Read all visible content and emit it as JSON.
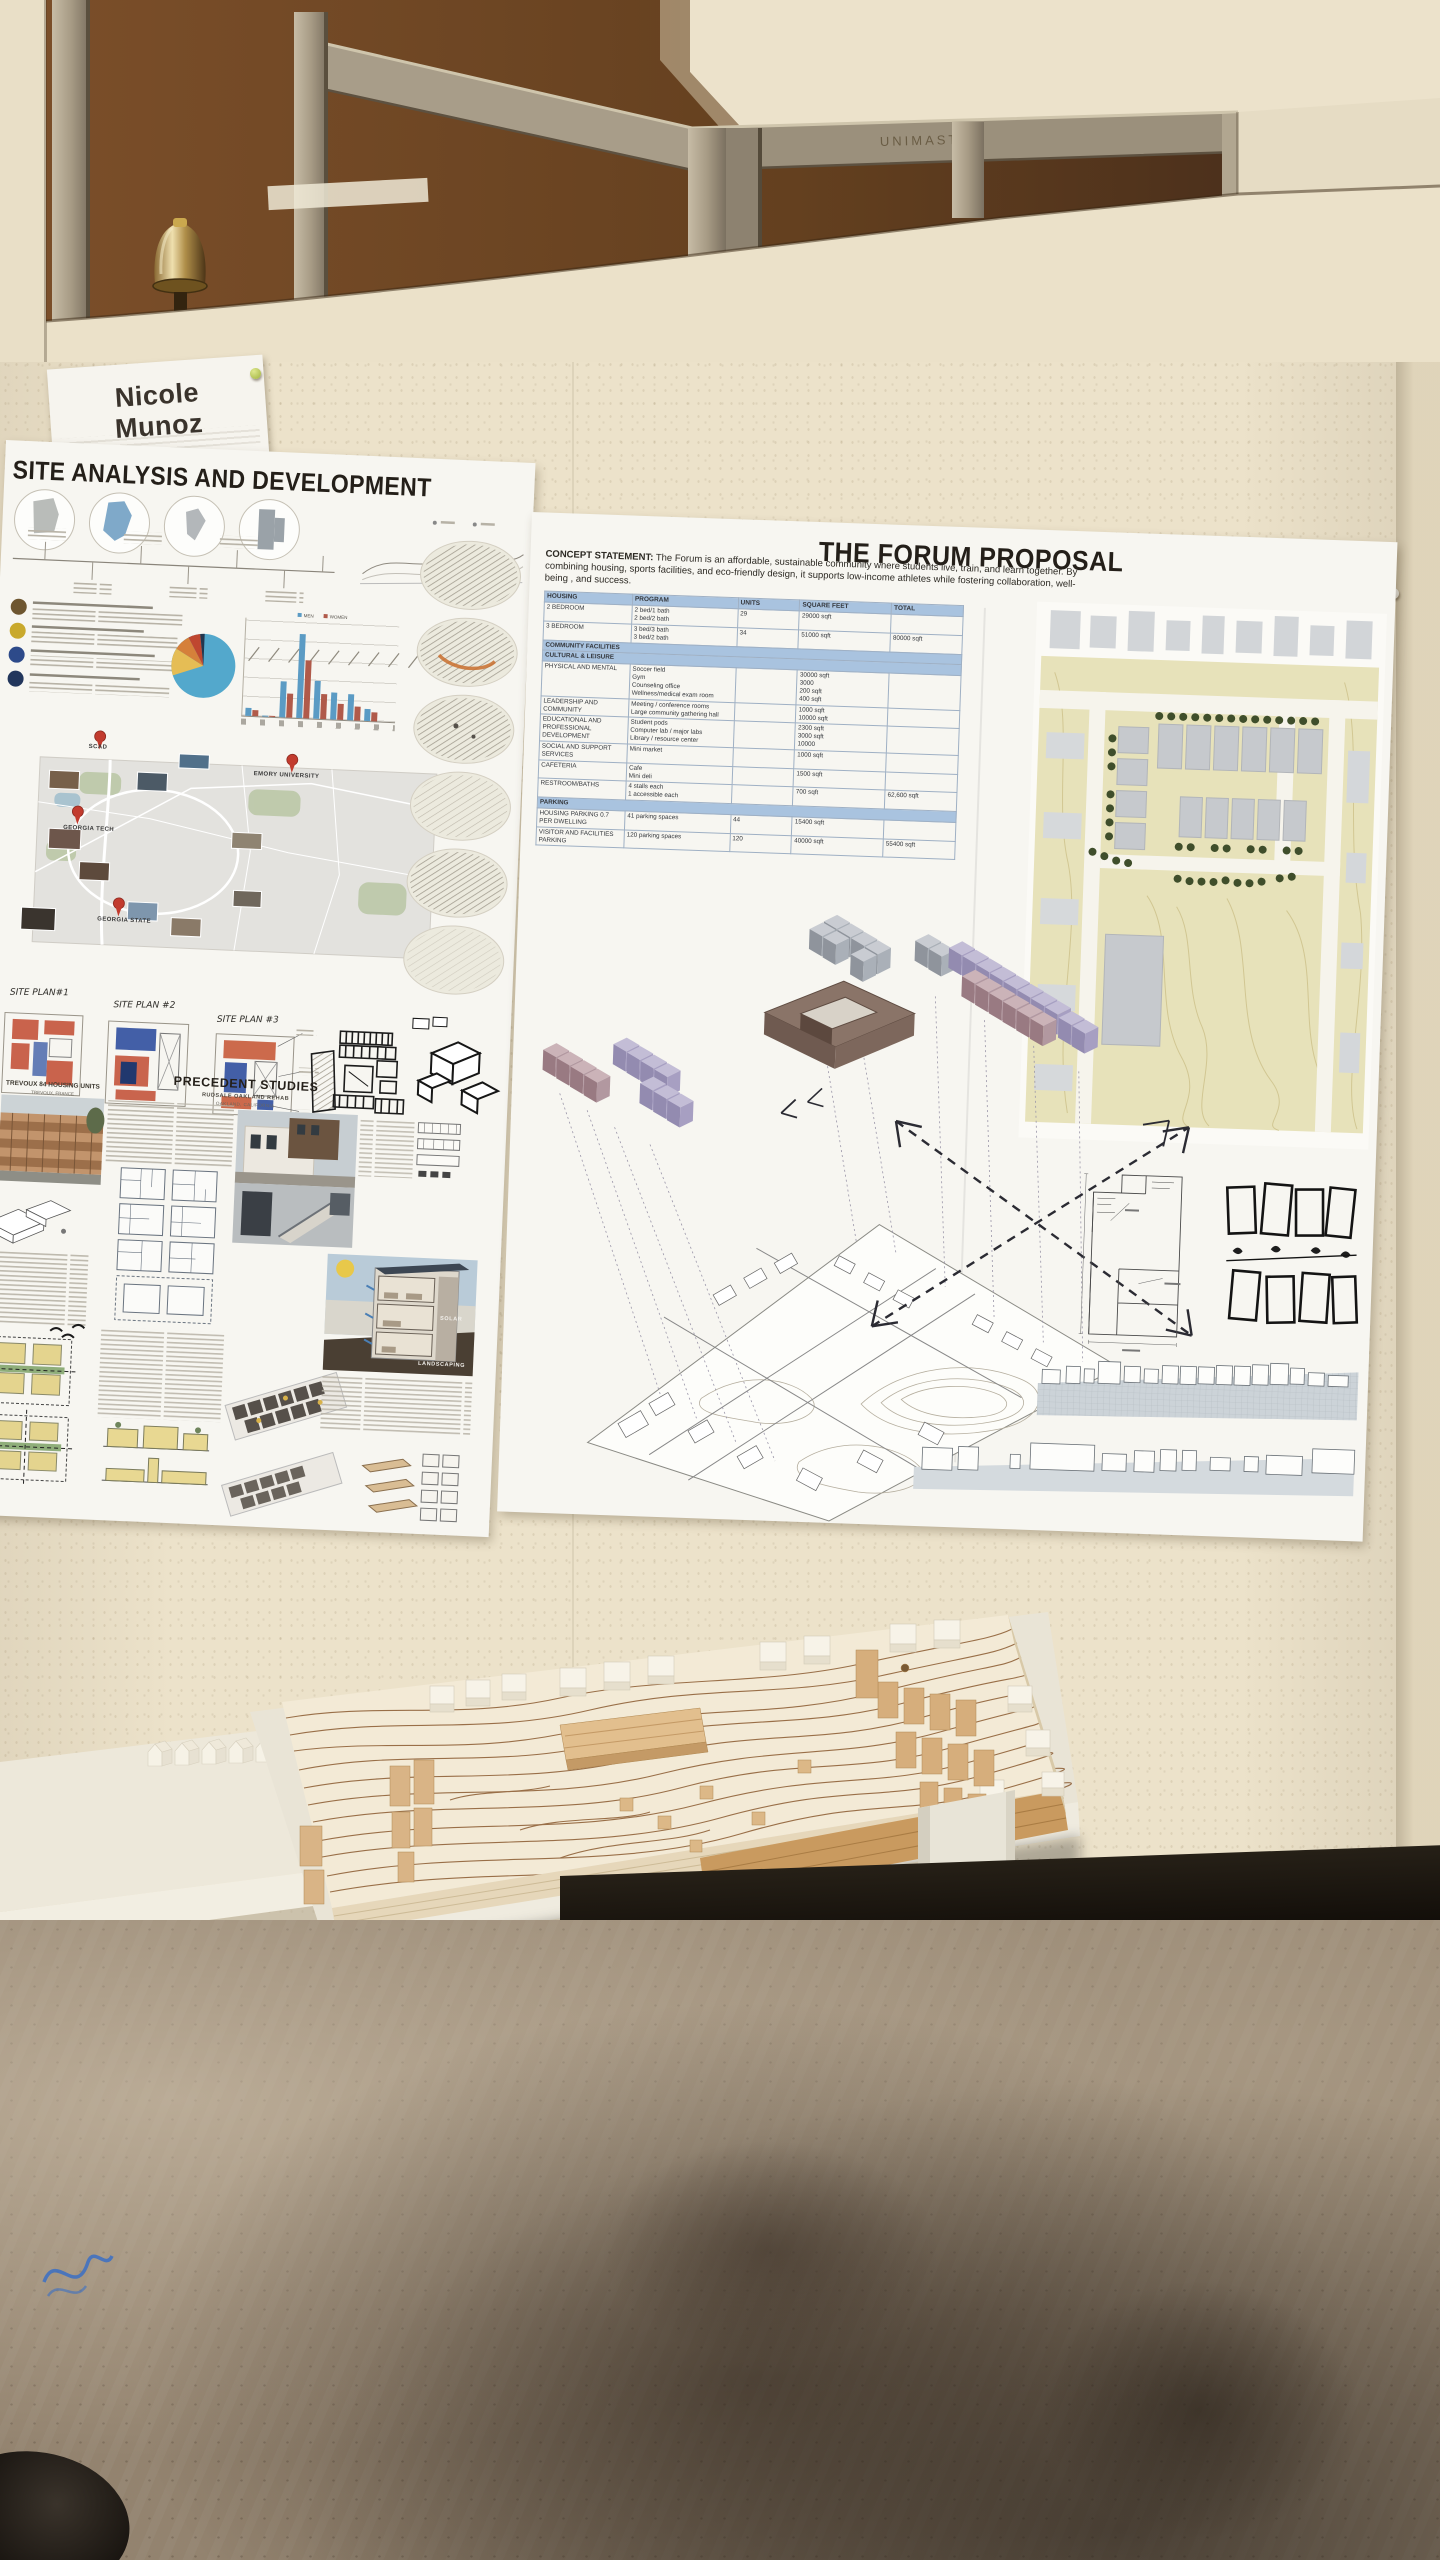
{
  "chart_data": [
    {
      "type": "pie",
      "title": "",
      "values": [
        72,
        11,
        8,
        5,
        4
      ],
      "labels": [
        "",
        "",
        "",
        "",
        ""
      ],
      "colors": [
        "#53a8cc",
        "#e5bd55",
        "#d5803a",
        "#bf4730",
        "#22364e"
      ],
      "legend_position": "none"
    },
    {
      "type": "bar",
      "title": "",
      "categories": [
        "",
        "",
        "",
        "",
        "",
        "",
        "",
        ""
      ],
      "series": [
        {
          "name": "MEN",
          "values": [
            8,
            1,
            38,
            88,
            40,
            28,
            27,
            12
          ]
        },
        {
          "name": "WOMEN",
          "values": [
            6,
            1,
            25,
            60,
            26,
            17,
            15,
            9
          ]
        }
      ],
      "ylim": [
        0,
        100
      ],
      "legend_position": "top",
      "colors": [
        "#5b9bc4",
        "#b05a4a"
      ]
    }
  ],
  "photo": {
    "framing_stamp": "UNIMAST",
    "name_card": {
      "line1": "Nicole",
      "line2": "Munoz"
    },
    "left_poster": {
      "title": "SITE ANALYSIS AND DEVELOPMENT",
      "sketch_labels": [
        "SITE PLAN#1",
        "SITE PLAN #2",
        "SITE PLAN #3"
      ],
      "precedent_heading": "PRECEDENT STUDIES",
      "precedent_subheading": "RUDSALE OAKLAND REHAB",
      "precedent_location": "OAKLAND, CALIFORNIA",
      "trevoux_heading": "TREVOUX 84 HOUSING UNITS",
      "trevoux_location": "TREVOUX, FRANCE",
      "map_labels": [
        "SCAD",
        "GEORGIA TECH",
        "GEORGIA STATE",
        "EMORY UNIVERSITY"
      ],
      "bar_legend": [
        "MEN",
        "WOMEN"
      ],
      "render_labels": [
        "SOLAR",
        "LANDSCAPING"
      ]
    },
    "right_poster": {
      "title": "THE FORUM PROPOSAL",
      "concept_label": "CONCEPT STATEMENT:",
      "concept_text": "The Forum is an affordable, sustainable community where students live, train, and learn together. By combining housing, sports facilities, and eco-friendly design, it supports low-income athletes while fostering collaboration, well-being , and success.",
      "program_table": {
        "headers": [
          "HOUSING",
          "PROGRAM",
          "UNITS",
          "SQUARE FEET",
          "TOTAL"
        ],
        "rows": [
          {
            "c": [
              "2 BEDROOM",
              "2 bed/1 bath\n2 bed/2 bath",
              "29",
              "29000 sqft",
              ""
            ]
          },
          {
            "c": [
              "3 BEDROOM",
              "3 bed/3 bath\n3 bed/2 bath",
              "34",
              "51000 sqft",
              "80000 sqft"
            ]
          },
          {
            "band": "COMMUNITY FACILITIES"
          },
          {
            "band": "CULTURAL & LEISURE"
          },
          {
            "c": [
              "PHYSICAL AND MENTAL",
              "Soccer field\nGym\nCounseling office\nWellness/medical exam room",
              "",
              "30000 sqft\n3000\n200 sqft\n400 sqft",
              ""
            ]
          },
          {
            "c": [
              "LEADERSHIP AND COMMUNITY",
              "Meeting / conference rooms\nLarge community gathering hall",
              "",
              "1000 sqft\n10000 sqft",
              ""
            ]
          },
          {
            "c": [
              "EDUCATIONAL AND PROFESSIONAL DEVELOPMENT",
              "Student pods\nComputer lab / major labs\nLibrary / resource center",
              "",
              "2300 sqft\n3000 sqft\n10000",
              ""
            ]
          },
          {
            "c": [
              "SOCIAL AND SUPPORT SERVICES",
              "Mini market",
              "",
              "1000 sqft",
              ""
            ]
          },
          {
            "c": [
              "CAFETERIA",
              "Cafe\nMini deli",
              "",
              "1500 sqft",
              ""
            ]
          },
          {
            "c": [
              "RESTROOM/BATHS",
              "4 stalls each\n1 accessible each",
              "",
              "700 sqft",
              "62,600 sqft"
            ]
          },
          {
            "band": "PARKING"
          },
          {
            "c": [
              "HOUSING PARKING 0.7 PER DWELLING",
              "41 parking spaces",
              "44",
              "15400 sqft",
              ""
            ]
          },
          {
            "c": [
              "VISITOR AND FACILITIES PARKING",
              "120 parking spaces",
              "120",
              "40000 sqft",
              "55400 sqft"
            ]
          }
        ]
      }
    }
  }
}
